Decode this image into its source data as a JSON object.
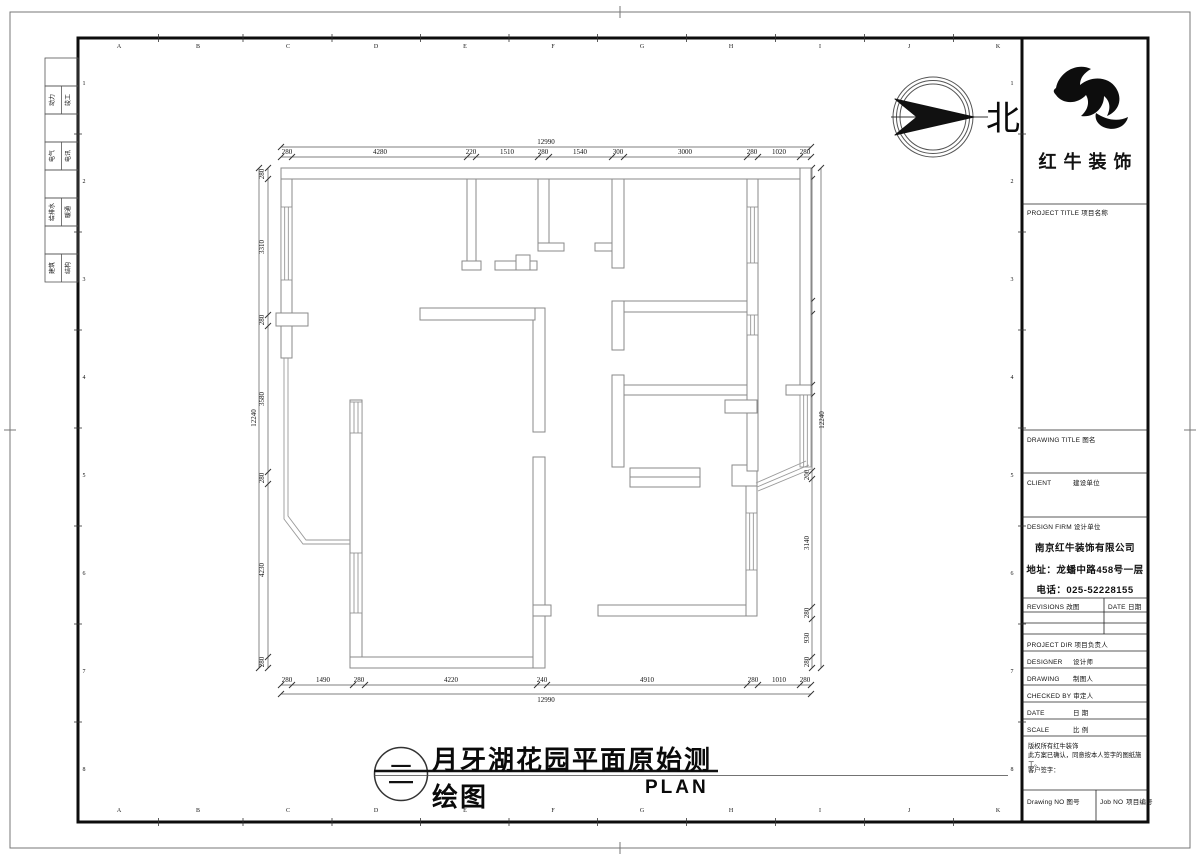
{
  "compass": {
    "label": "北"
  },
  "brand": {
    "name": "红牛装饰"
  },
  "sheet_title": {
    "cn": "月牙湖花园平面原始测绘图",
    "en": "PLAN",
    "sheet_symbol": "二"
  },
  "title_block": {
    "project_title": {
      "en": "PROJECT TITLE",
      "cn": "项目名称"
    },
    "drawing_title": {
      "en": "DRAWING TITLE",
      "cn": "图名"
    },
    "client": {
      "en": "CLIENT",
      "cn": "建设单位"
    },
    "design_firm": {
      "en": "DESIGN FIRM",
      "cn": "设计单位"
    },
    "firm_name": "南京红牛装饰有限公司",
    "firm_address": "地址：龙蟠中路458号一层",
    "firm_phone": "电话：025-52228155",
    "revisions": {
      "en": "REVISIONS",
      "cn": "改图"
    },
    "date_header": {
      "en": "DATE",
      "cn": "日期"
    },
    "project_dir": {
      "en": "PROJECT DIR",
      "cn": "项目负责人"
    },
    "designer": {
      "en": "DESIGNER",
      "cn": "设计师"
    },
    "drawing_by": {
      "en": "DRAWING",
      "cn": "制图人"
    },
    "checked_by": {
      "en": "CHECKED BY",
      "cn": "审定人"
    },
    "date_row": {
      "en": "DATE",
      "cn": "日  期"
    },
    "scale_row": {
      "en": "SCALE",
      "cn": "比  例"
    },
    "notes": [
      "版权所有红牛装饰",
      "此方案已确认，同意按本人签字的图纸施工。",
      "客户签字："
    ],
    "drawing_no": {
      "en": "Drawing NO",
      "cn": "图号"
    },
    "job_no": {
      "en": "Job NO",
      "cn": "项目编号"
    }
  },
  "signature_strip": {
    "labels": [
      [
        "动力",
        "竣工"
      ],
      [
        "电气",
        "电讯"
      ],
      [
        "给排水",
        "暖通"
      ],
      [
        "建筑",
        "结构"
      ]
    ]
  },
  "grid": {
    "letters": [
      "A",
      "B",
      "C",
      "D",
      "E",
      "F",
      "G",
      "H",
      "I",
      "J",
      "K"
    ],
    "letter_xs": [
      119,
      198,
      288,
      376,
      465,
      553,
      642,
      731,
      820,
      909,
      998
    ],
    "letters_y_top": 48,
    "letters_y_bottom": 812,
    "numbers": [
      "1",
      "2",
      "3",
      "4",
      "5",
      "6",
      "7",
      "8"
    ],
    "number_ys": [
      85,
      183,
      281,
      379,
      477,
      575,
      673,
      771
    ],
    "numbers_x_left": 84,
    "numbers_x_right": 1012
  },
  "plan_dims": {
    "top": {
      "overall": {
        "t": "12990",
        "x": 546,
        "y": 144
      },
      "labels": [
        [
          "280",
          287
        ],
        [
          "4280",
          380
        ],
        [
          "220",
          471
        ],
        [
          "1510",
          507
        ],
        [
          "280",
          543
        ],
        [
          "1540",
          580
        ],
        [
          "300",
          618
        ],
        [
          "3000",
          685
        ],
        [
          "280",
          752
        ],
        [
          "1020",
          779
        ],
        [
          "280",
          805
        ]
      ],
      "ticks": [
        281,
        292,
        467,
        476,
        538,
        549,
        612,
        624,
        747,
        758,
        800,
        811
      ],
      "label_y": 154,
      "tick_y": 157,
      "overall_tick_y": 147,
      "x1": 281,
      "x2": 811
    },
    "bottom": {
      "overall": {
        "t": "12990",
        "x": 546,
        "y": 702
      },
      "labels": [
        [
          "280",
          287
        ],
        [
          "1490",
          323
        ],
        [
          "280",
          359
        ],
        [
          "4220",
          451
        ],
        [
          "240",
          542
        ],
        [
          "4910",
          647
        ],
        [
          "280",
          753
        ],
        [
          "1010",
          779
        ],
        [
          "280",
          805
        ]
      ],
      "ticks": [
        281,
        292,
        353,
        365,
        537,
        547,
        747,
        758,
        800,
        811
      ],
      "label_y": 682,
      "tick_y": 685,
      "overall_tick_y": 694,
      "x1": 281,
      "x2": 811
    },
    "left": {
      "overall": {
        "t": "12240",
        "x": 256,
        "y": 418
      },
      "labels": [
        [
          "280",
          174
        ],
        [
          "3310",
          247
        ],
        [
          "280",
          320
        ],
        [
          "3580",
          399
        ],
        [
          "280",
          478
        ],
        [
          "4230",
          570
        ],
        [
          "280",
          662
        ]
      ],
      "ticks": [
        168,
        179,
        315,
        326,
        472,
        484,
        657,
        668
      ],
      "label_x": 264,
      "tick_x": 268,
      "overall_tick_x": 259,
      "y1": 168,
      "y2": 668
    },
    "right": {
      "overall": {
        "t": "12240",
        "x": 824,
        "y": 420
      },
      "labels": [
        [
          "280",
          174
        ],
        [
          "2980",
          240
        ],
        [
          "310",
          308
        ],
        [
          "1750",
          350
        ],
        [
          "250",
          390
        ],
        [
          "1840",
          433
        ],
        [
          "200",
          475
        ],
        [
          "3140",
          543
        ],
        [
          "280",
          613
        ],
        [
          "930",
          638
        ],
        [
          "280",
          662
        ]
      ],
      "ticks": [
        168,
        179,
        301,
        314,
        385,
        396,
        471,
        479,
        607,
        619,
        657,
        668
      ],
      "label_x": 809,
      "tick_x": 812,
      "overall_tick_x": 821,
      "y1": 168,
      "y2": 668
    }
  }
}
